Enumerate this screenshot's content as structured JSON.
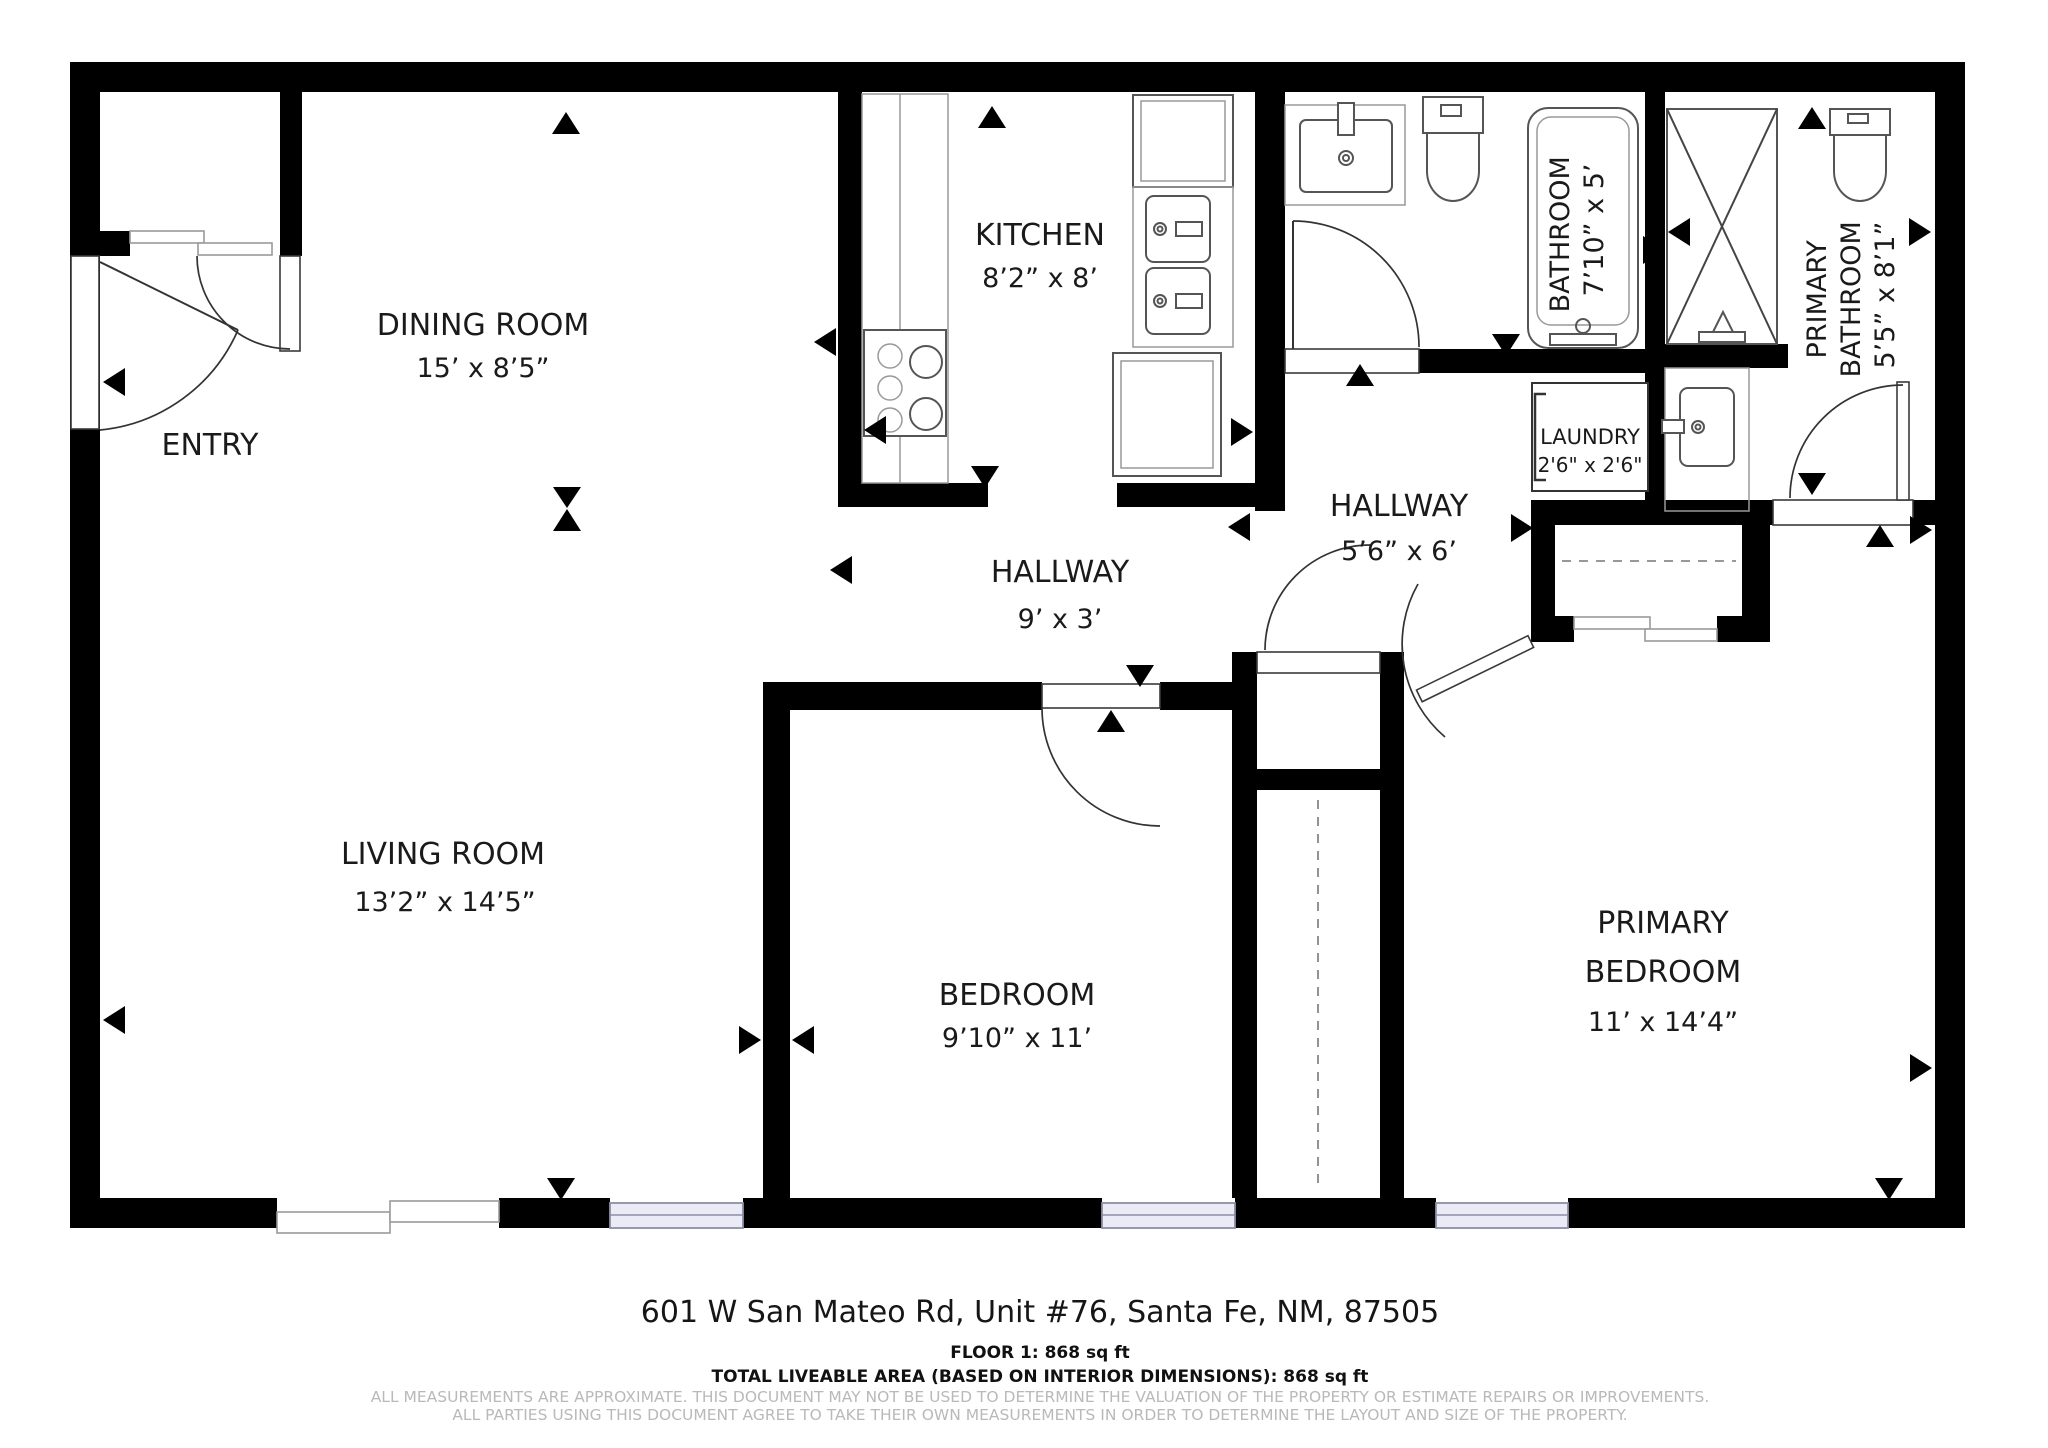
{
  "title": "Floor plan - 601 W San Mateo Rd Unit #76",
  "colors": {
    "walls": "#000000",
    "window_fill": "#ebebf7",
    "window_stroke": "#8e8ea6",
    "fixture_stroke": "#555555",
    "label_text": "#1a1a1a",
    "disclaimer_text": "#b9b9b9"
  },
  "rooms": {
    "dining": {
      "name": "DINING ROOM",
      "dims": "15’ x 8’5”"
    },
    "entry": {
      "name": "ENTRY"
    },
    "kitchen": {
      "name": "KITCHEN",
      "dims": "8’2” x 8’"
    },
    "bathroom": {
      "name": "BATHROOM",
      "dims": "7’10” x 5’"
    },
    "primary_bathroom": {
      "name_lines": [
        "PRIMARY",
        "BATHROOM"
      ],
      "dims": "5’5” x 8’1”"
    },
    "laundry": {
      "name": "LAUNDRY",
      "dims": "2'6\" x 2'6\""
    },
    "hallway_upper": {
      "name": "HALLWAY",
      "dims": "5’6” x 6’"
    },
    "hallway_lower": {
      "name": "HALLWAY",
      "dims": "9’ x 3’"
    },
    "living": {
      "name": "LIVING ROOM",
      "dims": "13’2” x 14’5”"
    },
    "bedroom": {
      "name": "BEDROOM",
      "dims": "9’10” x 11’"
    },
    "primary_bedroom": {
      "name_lines": [
        "PRIMARY",
        "BEDROOM"
      ],
      "dims": "11’ x 14’4”"
    }
  },
  "footer": {
    "address": "601 W San Mateo Rd, Unit #76, Santa Fe, NM, 87505",
    "floor_line": "FLOOR 1: 868 sq ft",
    "total_line": "TOTAL LIVEABLE AREA (BASED ON INTERIOR DIMENSIONS): 868 sq ft",
    "disclaimer_line1": "ALL MEASUREMENTS ARE APPROXIMATE. THIS DOCUMENT MAY NOT BE USED TO DETERMINE THE VALUATION OF THE PROPERTY OR ESTIMATE REPAIRS OR IMPROVEMENTS.",
    "disclaimer_line2": "ALL PARTIES USING THIS DOCUMENT AGREE TO TAKE THEIR OWN MEASUREMENTS IN ORDER TO DETERMINE THE LAYOUT AND SIZE OF THE PROPERTY."
  }
}
